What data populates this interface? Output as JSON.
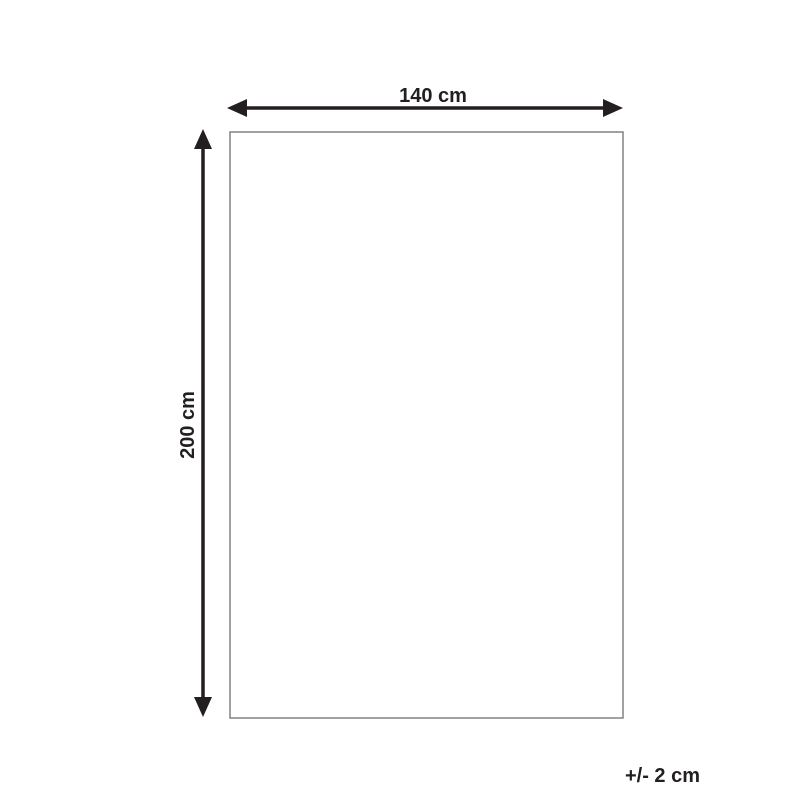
{
  "diagram": {
    "title": "Product dimension diagram",
    "width_label": "140 cm",
    "height_label": "200 cm",
    "tolerance_label": "+/- 2 cm",
    "colors": {
      "arrow": "#231f20",
      "text": "#231f20",
      "rectangle_border": "#808285",
      "background": "#ffffff"
    }
  }
}
